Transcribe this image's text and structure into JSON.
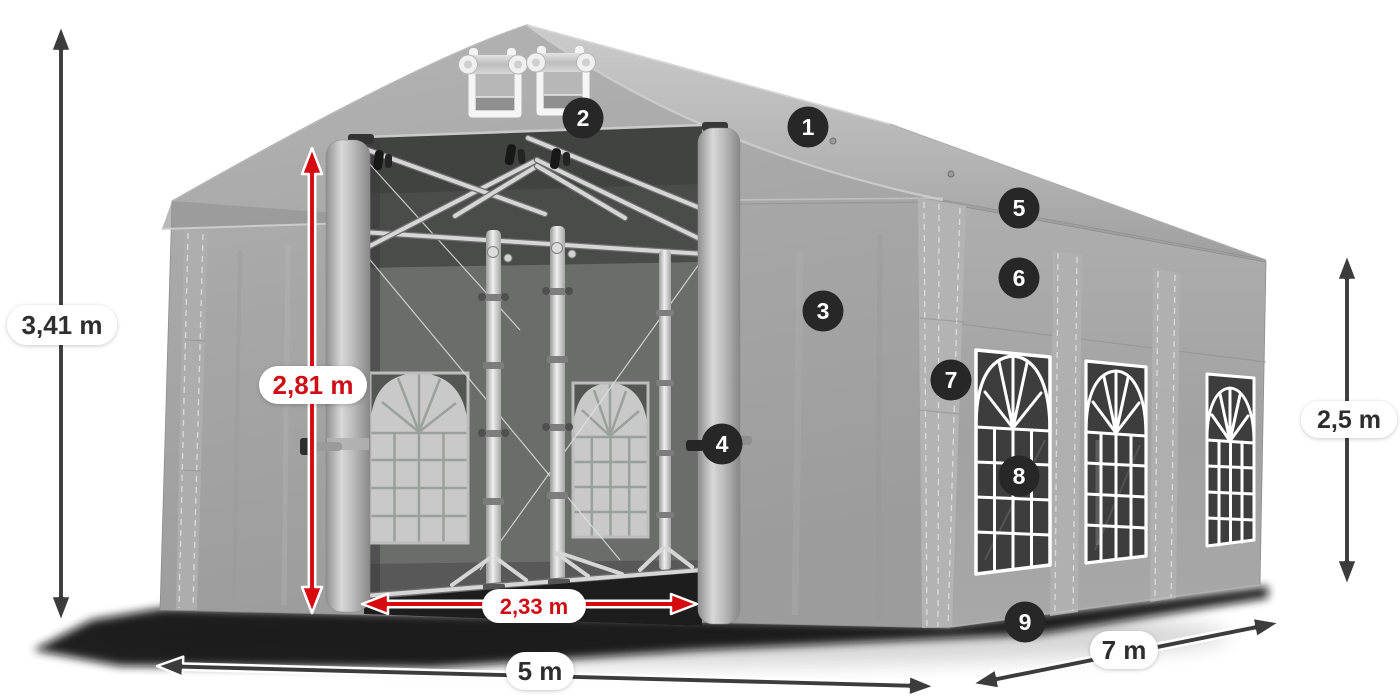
{
  "diagram": {
    "subject": "Party tent / marquee 3D product illustration with dimension annotations",
    "dimensions": {
      "total_height": {
        "label": "3,41 m",
        "style": "dark"
      },
      "entrance_height": {
        "label": "2,81 m",
        "style": "red"
      },
      "entrance_width": {
        "label": "2,33 m",
        "style": "red"
      },
      "front_width": {
        "label": "5 m",
        "style": "dark"
      },
      "side_length": {
        "label": "7 m",
        "style": "dark"
      },
      "side_wall_height": {
        "label": "2,5 m",
        "style": "dark"
      }
    },
    "callouts": [
      "1",
      "2",
      "3",
      "4",
      "5",
      "6",
      "7",
      "8",
      "9"
    ],
    "colors": {
      "red_accent": "#d60b10",
      "red_text": "#cf0d13",
      "dark_arrow": "#3c3c3c",
      "dark_text": "#2d2d2d",
      "badge_bg": "#272727",
      "badge_text": "#ffffff",
      "pill_bg": "#ffffff",
      "background": "#ffffff"
    }
  }
}
